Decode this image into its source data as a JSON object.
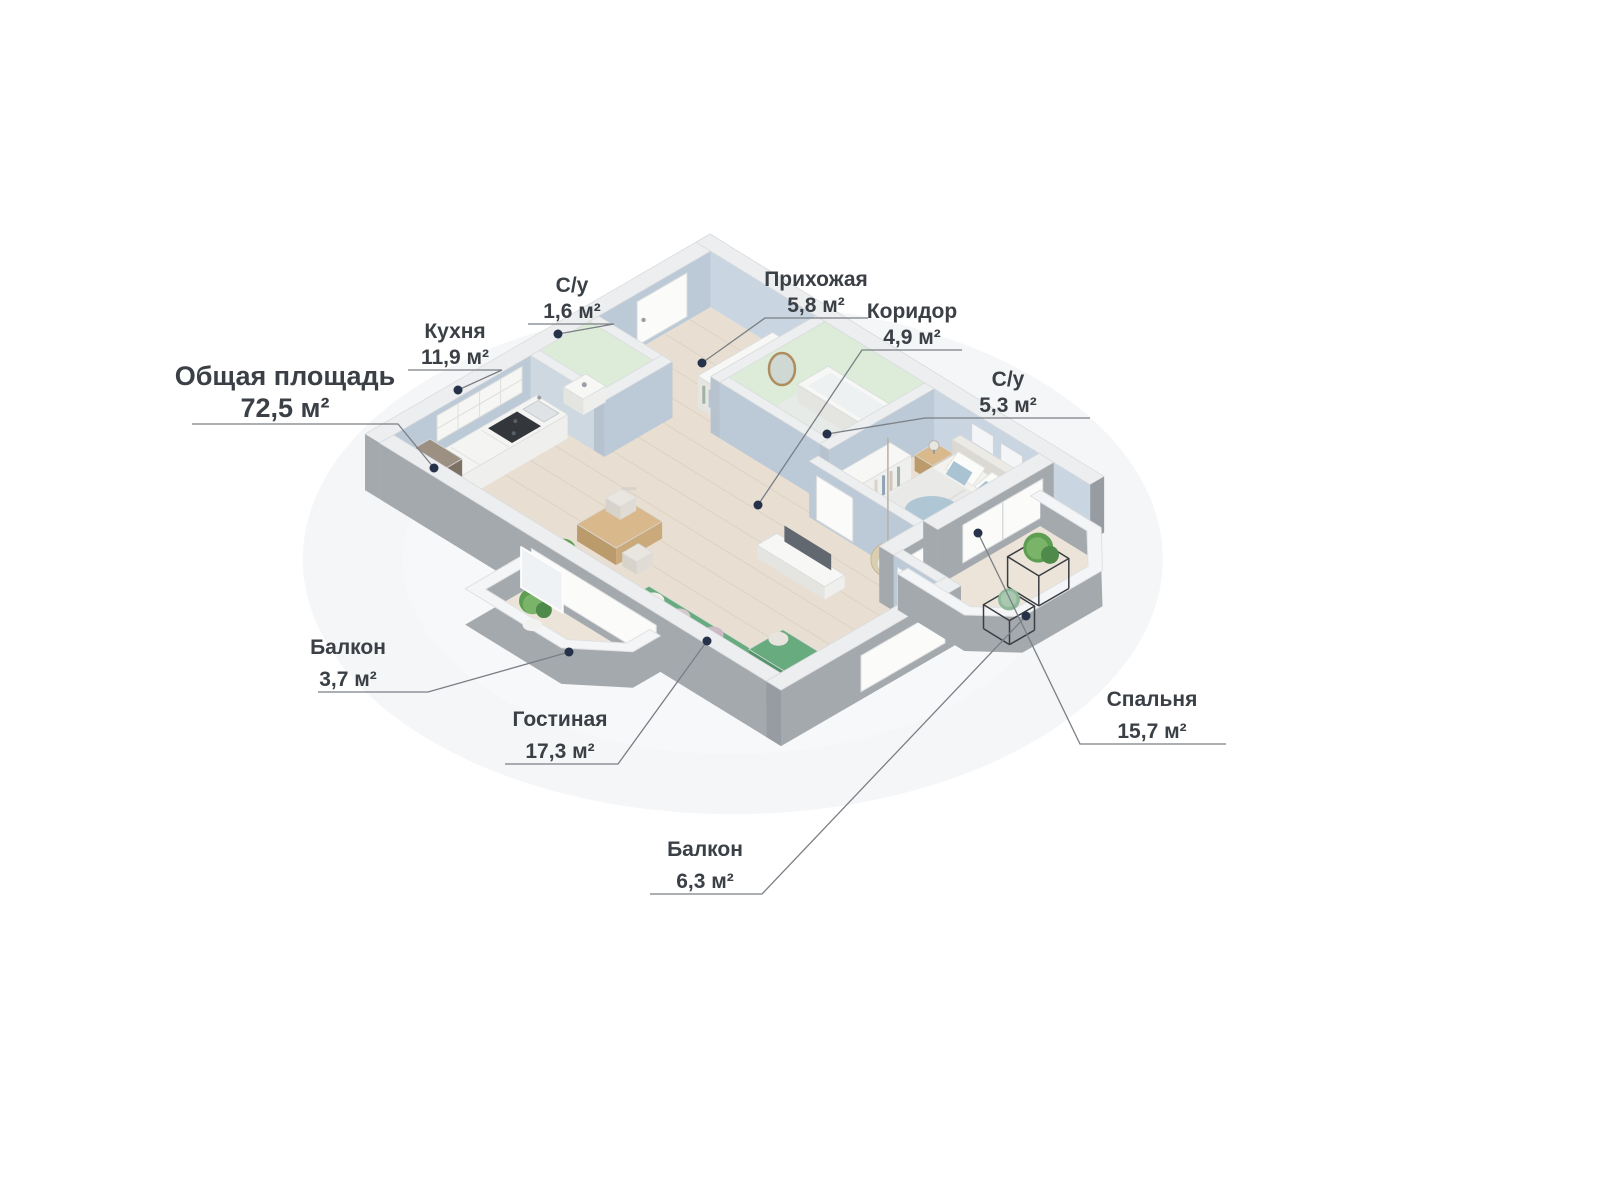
{
  "title": "Общая площадь 72,5 м²",
  "labels": {
    "total": {
      "name": "Общая площадь",
      "area": "72,5 м²"
    },
    "kitchen": {
      "name": "Кухня",
      "area": "11,9 м²"
    },
    "wc_small": {
      "name": "С/у",
      "area": "1,6 м²"
    },
    "hallway": {
      "name": "Прихожая",
      "area": "5,8 м²"
    },
    "corridor": {
      "name": "Коридор",
      "area": "4,9 м²"
    },
    "bathroom": {
      "name": "С/у",
      "area": "5,3 м²"
    },
    "balcony_left": {
      "name": "Балкон",
      "area": "3,7 м²"
    },
    "living": {
      "name": "Гостиная",
      "area": "17,3 м²"
    },
    "balcony_bottom": {
      "name": "Балкон",
      "area": "6,3 м²"
    },
    "bedroom": {
      "name": "Спальня",
      "area": "15,7 м²"
    }
  },
  "palette": {
    "background": "#ffffff",
    "wall_top": "#eceef0",
    "wall_exterior": "#a4a9ae",
    "wall_exterior_dark": "#969ca2",
    "wall_interior_blue": "#bcc9d6",
    "wall_interior_blue_light": "#c9d5e0",
    "bathroom_green": "#dcecd8",
    "floor_wood": "#e8dfd2",
    "floor_wood_line": "#d9cfc0",
    "floor_balcony": "#ece4d8",
    "floor_tile": "#e7ebe7",
    "white_furniture": "#f7f7f5",
    "white_furniture_side": "#e4e4e0",
    "sofa_green": "#68ab7e",
    "sofa_green_dark": "#55946a",
    "wood_furniture": "#d9b98c",
    "wood_furniture_dark": "#bb9a6b",
    "fridge_brown": "#8b7e6f",
    "cooktop_dark": "#33373c",
    "tv_gray": "#616870",
    "textile_blue": "#a9c3d3",
    "plant_green": "#5d9e53",
    "plant_green_light": "#7ab468",
    "metal_frame": "#3a3e43",
    "rattan": "#d9cdb2",
    "label_text": "#3b4046",
    "leader_line": "#7a7f85",
    "anchor_dot": "#26324a"
  }
}
